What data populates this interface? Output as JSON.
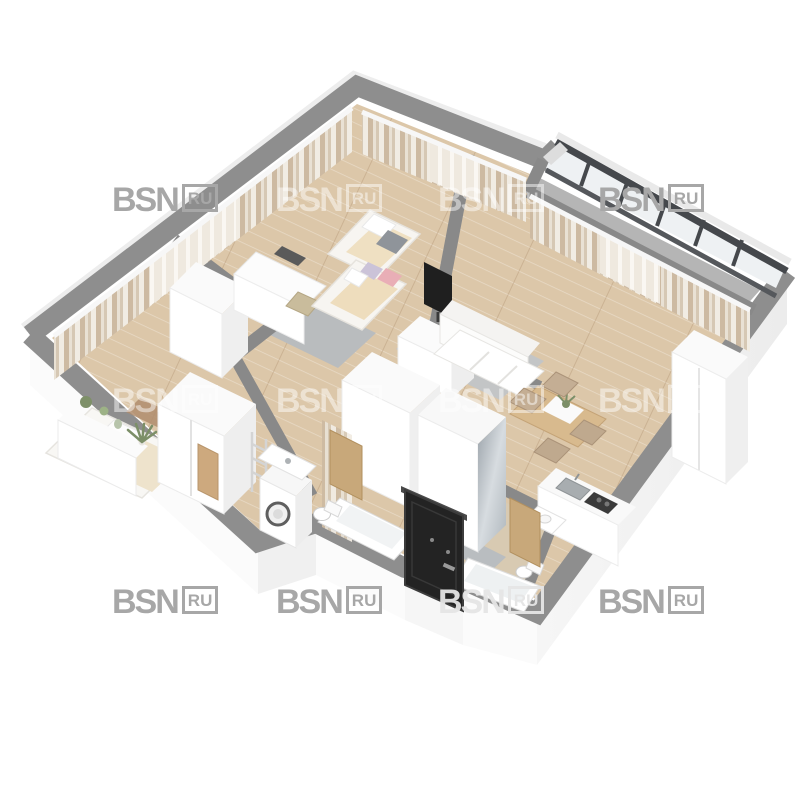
{
  "watermark": {
    "brand": "BSN",
    "suffix": "RU"
  },
  "scene": {
    "type": "apartment-floor-plan-3d-isometric",
    "rooms": [
      "master-bedroom",
      "kids-room",
      "living-room",
      "kitchen",
      "hallway",
      "bathroom",
      "toilet-bathroom",
      "balcony",
      "entrance"
    ],
    "colors": {
      "background": "#ffffff",
      "wall_top": "#8e8e8e",
      "plinth": "#f7f7f7",
      "floor_wood": "#dcc7a9",
      "curtain_beige": "#c7b49c",
      "balcony_frame": "#45484c",
      "entrance_door": "#222222",
      "accent_pink": "#e9aeb6",
      "rug_gray": "#b9bcbe"
    }
  }
}
